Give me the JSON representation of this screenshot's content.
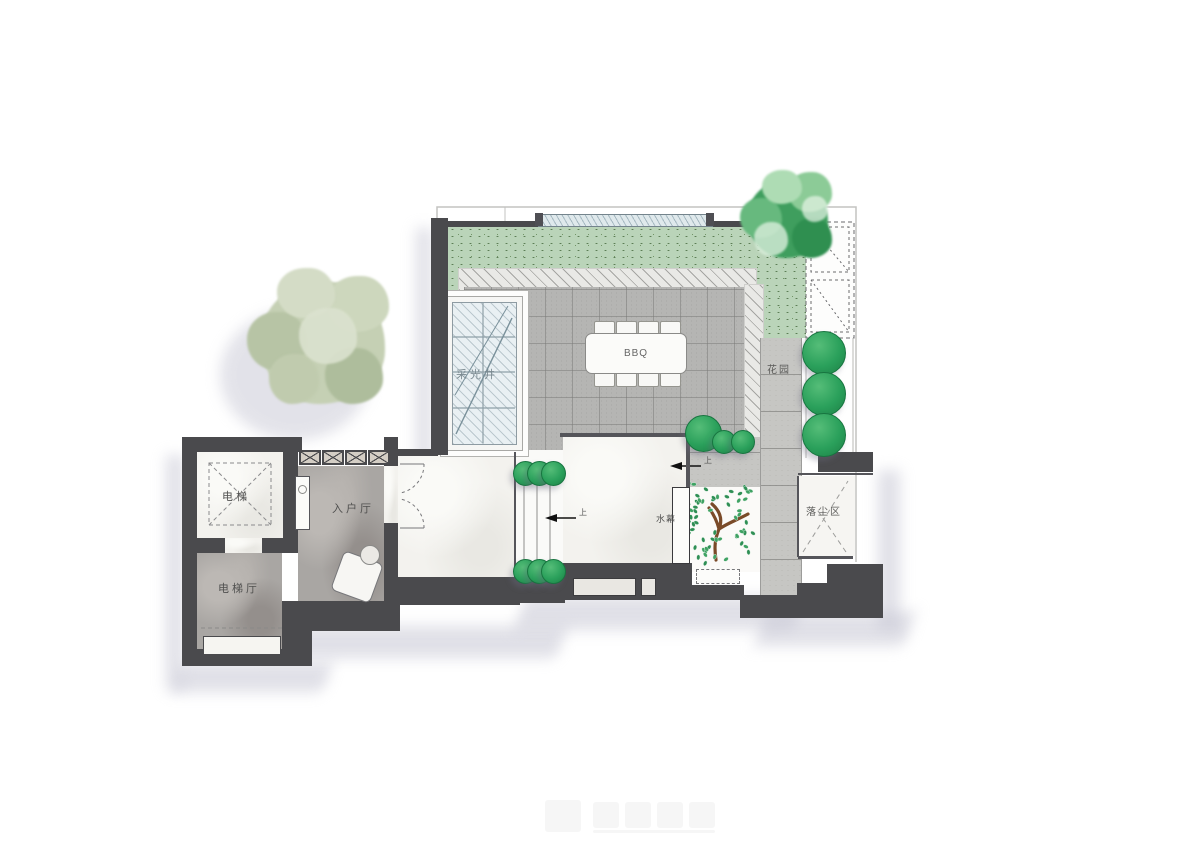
{
  "plan": {
    "type": "residential floor plan, top view rendering",
    "labels": {
      "elevator": "电梯",
      "elevator_hall": "电梯厅",
      "entry_hall": "入户厅",
      "light_well": "采光井",
      "bbq": "BBQ",
      "garden": "花园",
      "water_curtain": "水幕",
      "dust_area": "落尘区",
      "up_step_1": "上",
      "up_step_2": "上"
    },
    "colors": {
      "wall": "#4a4a4d",
      "grass": "#bad4b9",
      "tiles": "#b5b5b3",
      "marble_white": "#f3f2ee",
      "marble_gray": "#a9a6a3",
      "tree_green": "#2aa05b",
      "pale_tree": "#c5d0b5",
      "glass": "#e9f0f3",
      "shadow": "#c7c7d4"
    }
  }
}
